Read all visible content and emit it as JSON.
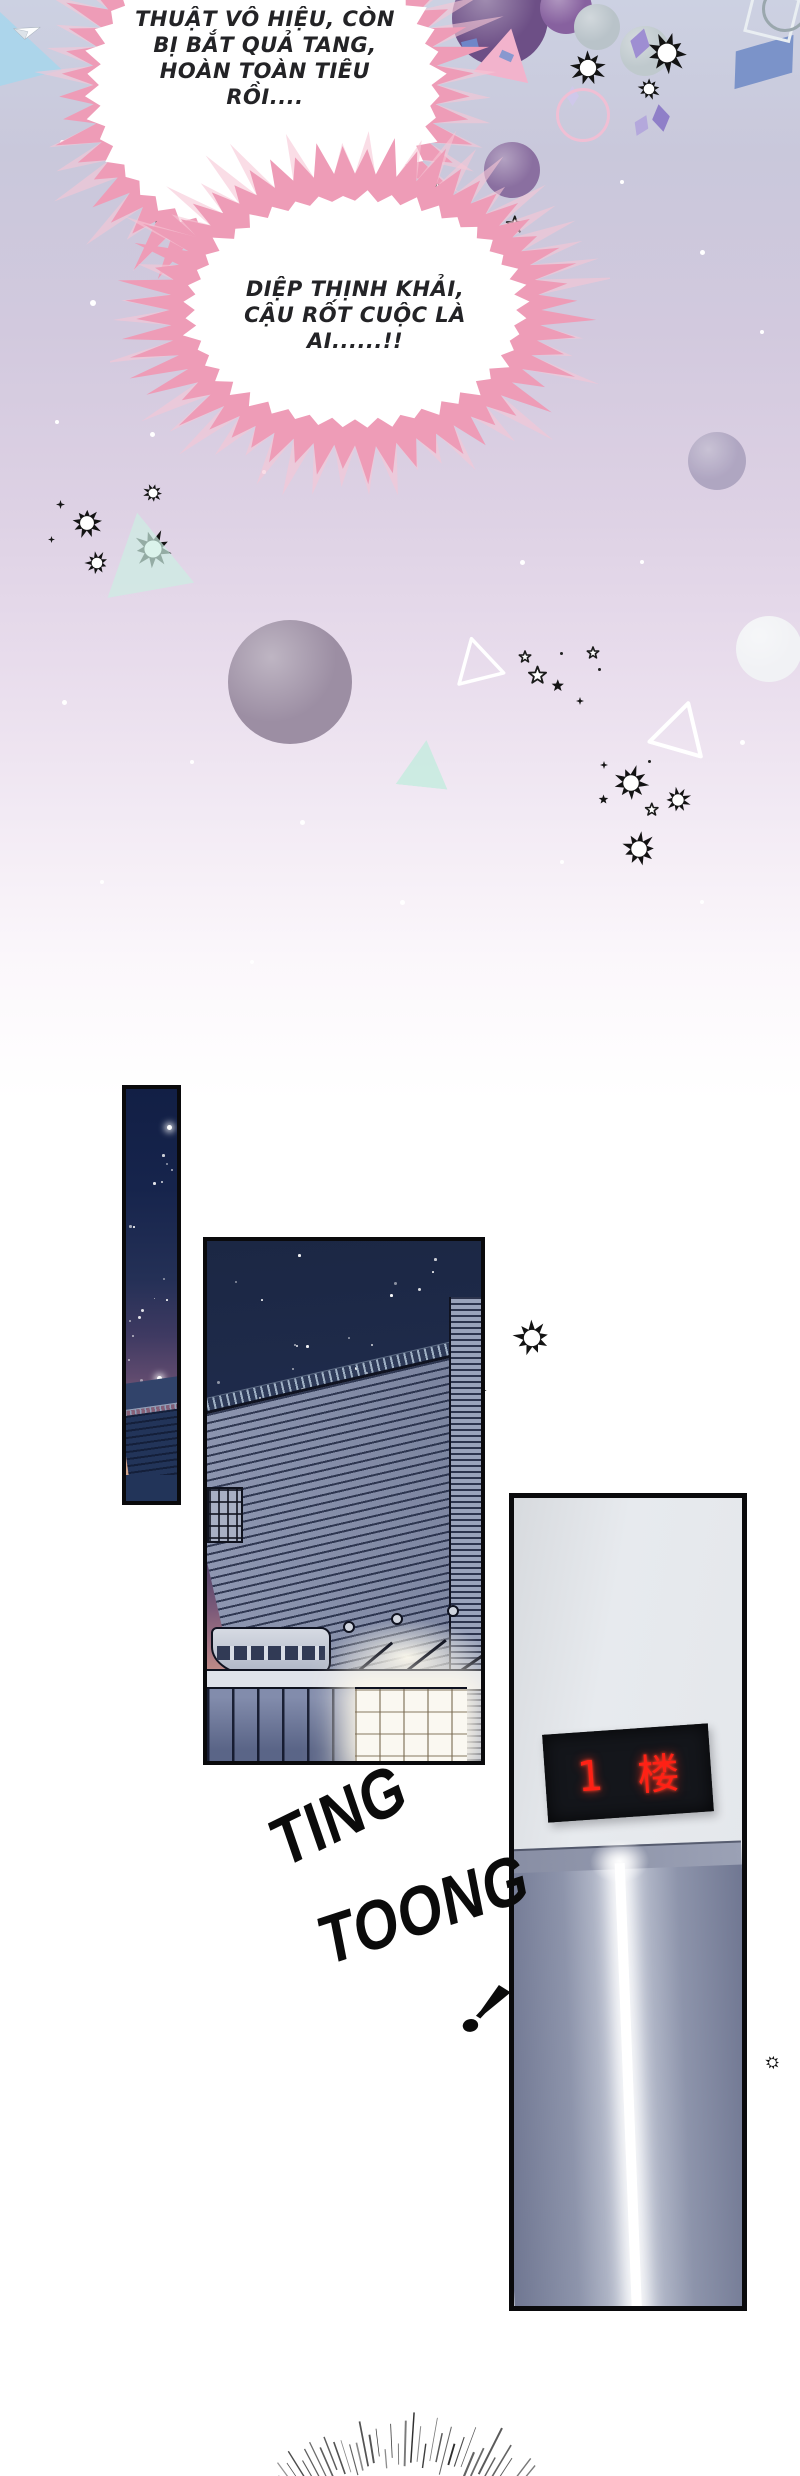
{
  "scene": {
    "type": "comic-webtoon-page",
    "sections": [
      "celebration-burst-speech",
      "night-building-exterior",
      "elevator-arrival"
    ]
  },
  "speech_bubbles": [
    {
      "id": "bubble-1",
      "shape": "spiky-burst",
      "spike_color": "#ee9cb7",
      "lines": [
        "THUẬT VÔ HIỆU, CÒN",
        "BỊ BẮT QUẢ TANG,",
        "HOÀN TOÀN TIÊU",
        "RỒI...."
      ]
    },
    {
      "id": "bubble-2",
      "shape": "spiky-burst",
      "spike_color": "#ee9cb7",
      "lines": [
        "DIỆP THỊNH KHẢI,",
        "CẬU RỐT CUỘC LÀ",
        "AI......!!"
      ]
    }
  ],
  "sfx": {
    "elevator_chime": [
      "TING",
      "TOONG"
    ],
    "exclaim": "!"
  },
  "elevator": {
    "display_floor": "1",
    "display_unit": "楼",
    "display_text_color": "#ff2115",
    "display_bg": "#14161b",
    "wall_color": "#e3e6ea"
  },
  "colors": {
    "background_top": "#ccd1e2",
    "bubble_pink": "#ee9cb7",
    "bubble_pink_light": "#f7c6d6",
    "night_sky": "#1b2744",
    "dusk_peach": "#d3a68e",
    "panel_border": "#0a0a0c"
  },
  "decorations": [
    {
      "t": "wedge",
      "x": 0,
      "y": 12,
      "w": 62,
      "h": 74,
      "c": "#a7d6ec",
      "o": 0.85
    },
    {
      "t": "plane",
      "x": 12,
      "y": 22,
      "s": 26,
      "r": 18
    },
    {
      "t": "ball",
      "x": 452,
      "y": -30,
      "s": 96,
      "c": "#6d4f86"
    },
    {
      "t": "ball",
      "x": 540,
      "y": -18,
      "s": 52,
      "c": "#87619f"
    },
    {
      "t": "ball",
      "x": 574,
      "y": 4,
      "s": 46,
      "c": "#b9c3c9"
    },
    {
      "t": "tri",
      "x": 478,
      "y": 28,
      "s": 56,
      "r": 12,
      "c": "#f2b3cc"
    },
    {
      "t": "rect",
      "x": 462,
      "y": 40,
      "w": 16,
      "h": 10,
      "r": -14,
      "c": "#6f86c8"
    },
    {
      "t": "rect",
      "x": 500,
      "y": 52,
      "w": 13,
      "h": 8,
      "r": 24,
      "c": "#8898cf"
    },
    {
      "t": "ball",
      "x": 620,
      "y": 26,
      "s": 50,
      "c": "#bfc9cd"
    },
    {
      "t": "burst",
      "x": 568,
      "y": 48,
      "s": 40
    },
    {
      "t": "burst",
      "x": 644,
      "y": 30,
      "s": 46
    },
    {
      "t": "burst",
      "x": 636,
      "y": 76,
      "s": 26
    },
    {
      "t": "diamond",
      "x": 630,
      "y": 28,
      "s": 20,
      "r": 15,
      "c": "#9e8ed2"
    },
    {
      "t": "diamond",
      "x": 652,
      "y": 104,
      "s": 18,
      "r": -10,
      "c": "#8f7fc8"
    },
    {
      "t": "diamond",
      "x": 634,
      "y": 114,
      "s": 15,
      "r": 25,
      "c": "#b4a8dc"
    },
    {
      "t": "diamond",
      "x": 566,
      "y": 86,
      "s": 13,
      "r": 0,
      "c": "#cfc8ea"
    },
    {
      "t": "para",
      "x": 734,
      "y": 44,
      "w": 60,
      "h": 36,
      "r": -16,
      "c": "#7b93c9"
    },
    {
      "t": "rect-o",
      "x": 748,
      "y": -8,
      "w": 42,
      "h": 40,
      "r": 14,
      "c": "#e9eef2"
    },
    {
      "t": "ring",
      "x": 762,
      "y": -14,
      "s": 40,
      "c": "#9aa7ad"
    },
    {
      "t": "ball",
      "x": 484,
      "y": 142,
      "s": 56,
      "c": "#8a6fa0"
    },
    {
      "t": "ring",
      "x": 556,
      "y": 88,
      "s": 48,
      "c": "#f0bfd4"
    },
    {
      "t": "star4",
      "x": 406,
      "y": 178,
      "s": 9
    },
    {
      "t": "star",
      "x": 424,
      "y": 176,
      "s": 18
    },
    {
      "t": "star",
      "x": 282,
      "y": 208,
      "s": 13
    },
    {
      "t": "star",
      "x": 360,
      "y": 224,
      "s": 26
    },
    {
      "t": "star",
      "x": 468,
      "y": 206,
      "s": 13
    },
    {
      "t": "star",
      "x": 502,
      "y": 212,
      "s": 17
    },
    {
      "t": "star",
      "x": 150,
      "y": 206,
      "s": 14
    },
    {
      "t": "ball",
      "x": 220,
      "y": 255,
      "s": 30,
      "c": "#f3f5f8"
    },
    {
      "t": "ball",
      "x": 328,
      "y": 254,
      "s": 30,
      "c": "#5d7382"
    },
    {
      "t": "ball",
      "x": 392,
      "y": 262,
      "s": 46,
      "c": "#e9ecef"
    },
    {
      "t": "ball",
      "x": 688,
      "y": 432,
      "s": 58,
      "c": "#a89fbc",
      "o": 0.85
    },
    {
      "t": "plane",
      "x": 165,
      "y": 283,
      "s": 92,
      "r": 10
    },
    {
      "t": "tri",
      "x": 212,
      "y": 354,
      "s": 20,
      "r": -6,
      "c": "#bfe8da",
      "o": 0.8
    },
    {
      "t": "dot",
      "x": 300,
      "y": 222,
      "s": 4,
      "c": "#222"
    },
    {
      "t": "dot",
      "x": 352,
      "y": 228,
      "s": 3,
      "c": "#222"
    },
    {
      "t": "dot",
      "x": 408,
      "y": 244,
      "s": 4,
      "c": "#222"
    },
    {
      "t": "dot",
      "x": 396,
      "y": 256,
      "s": 3,
      "c": "#222"
    },
    {
      "t": "dot",
      "x": 300,
      "y": 242,
      "s": 3,
      "c": "#222"
    },
    {
      "t": "dot",
      "x": 528,
      "y": 270,
      "s": 3,
      "c": "#222"
    },
    {
      "t": "burst",
      "x": 70,
      "y": 506,
      "s": 34
    },
    {
      "t": "burst",
      "x": 142,
      "y": 482,
      "s": 22
    },
    {
      "t": "burst",
      "x": 132,
      "y": 528,
      "s": 42
    },
    {
      "t": "burst",
      "x": 84,
      "y": 550,
      "s": 26
    },
    {
      "t": "star4",
      "x": 56,
      "y": 496,
      "s": 9
    },
    {
      "t": "star4",
      "x": 48,
      "y": 530,
      "s": 7
    },
    {
      "t": "tri",
      "x": 100,
      "y": 512,
      "s": 88,
      "r": -10,
      "c": "#cceee2",
      "o": 0.7
    },
    {
      "t": "ball",
      "x": 228,
      "y": 620,
      "s": 124,
      "c": "#9c8ea3"
    },
    {
      "t": "tri-o",
      "x": 452,
      "y": 636,
      "s": 50,
      "r": -14,
      "c": "#ffffff"
    },
    {
      "t": "star",
      "x": 524,
      "y": 662,
      "s": 18
    },
    {
      "t": "tri",
      "x": 398,
      "y": 740,
      "s": 52,
      "r": 6,
      "c": "#c5ebdf",
      "o": 0.85
    },
    {
      "t": "star",
      "x": 516,
      "y": 648,
      "s": 12
    },
    {
      "t": "star-f",
      "x": 548,
      "y": 676,
      "s": 13
    },
    {
      "t": "star",
      "x": 584,
      "y": 644,
      "s": 12
    },
    {
      "t": "star4",
      "x": 576,
      "y": 692,
      "s": 8
    },
    {
      "t": "dot",
      "x": 560,
      "y": 652,
      "s": 3,
      "c": "#222"
    },
    {
      "t": "dot",
      "x": 598,
      "y": 668,
      "s": 3,
      "c": "#222"
    },
    {
      "t": "ball",
      "x": 736,
      "y": 616,
      "s": 66,
      "c": "#f1f2f5"
    },
    {
      "t": "tri-o",
      "x": 652,
      "y": 700,
      "s": 58,
      "r": 16,
      "c": "#ffffff"
    },
    {
      "t": "burst",
      "x": 612,
      "y": 764,
      "s": 38
    },
    {
      "t": "star",
      "x": 642,
      "y": 800,
      "s": 13
    },
    {
      "t": "burst",
      "x": 664,
      "y": 786,
      "s": 28
    },
    {
      "t": "burst",
      "x": 620,
      "y": 830,
      "s": 38
    },
    {
      "t": "star4",
      "x": 600,
      "y": 756,
      "s": 8
    },
    {
      "t": "star-f",
      "x": 596,
      "y": 792,
      "s": 10
    },
    {
      "t": "dot",
      "x": 648,
      "y": 760,
      "s": 3,
      "c": "#222"
    },
    {
      "t": "dot",
      "x": 60,
      "y": 140,
      "s": 5,
      "c": "#fff"
    },
    {
      "t": "dot",
      "x": 200,
      "y": 170,
      "s": 4,
      "c": "#fff"
    },
    {
      "t": "dot",
      "x": 330,
      "y": 142,
      "s": 5,
      "c": "#fff"
    },
    {
      "t": "dot",
      "x": 90,
      "y": 300,
      "s": 6,
      "c": "#fff"
    },
    {
      "t": "dot",
      "x": 55,
      "y": 420,
      "s": 4,
      "c": "#fff"
    },
    {
      "t": "dot",
      "x": 150,
      "y": 432,
      "s": 5,
      "c": "#fff"
    },
    {
      "t": "dot",
      "x": 262,
      "y": 470,
      "s": 4,
      "c": "#fff"
    },
    {
      "t": "dot",
      "x": 500,
      "y": 380,
      "s": 6,
      "c": "#fff"
    },
    {
      "t": "dot",
      "x": 620,
      "y": 180,
      "s": 4,
      "c": "#fff"
    },
    {
      "t": "dot",
      "x": 700,
      "y": 250,
      "s": 5,
      "c": "#fff"
    },
    {
      "t": "dot",
      "x": 760,
      "y": 330,
      "s": 4,
      "c": "#fff"
    },
    {
      "t": "dot",
      "x": 62,
      "y": 700,
      "s": 5,
      "c": "#fff"
    },
    {
      "t": "dot",
      "x": 190,
      "y": 760,
      "s": 4,
      "c": "#fff"
    },
    {
      "t": "dot",
      "x": 300,
      "y": 820,
      "s": 5,
      "c": "#fff"
    },
    {
      "t": "dot",
      "x": 520,
      "y": 560,
      "s": 5,
      "c": "#fff"
    },
    {
      "t": "dot",
      "x": 640,
      "y": 560,
      "s": 4,
      "c": "#fff"
    },
    {
      "t": "dot",
      "x": 740,
      "y": 740,
      "s": 5,
      "c": "#fff"
    },
    {
      "t": "dot",
      "x": 100,
      "y": 880,
      "s": 4,
      "c": "#fff"
    },
    {
      "t": "dot",
      "x": 400,
      "y": 900,
      "s": 5,
      "c": "#fff"
    },
    {
      "t": "dot",
      "x": 700,
      "y": 900,
      "s": 4,
      "c": "#fff"
    },
    {
      "t": "dot",
      "x": 250,
      "y": 960,
      "s": 4,
      "c": "#fff"
    },
    {
      "t": "dot",
      "x": 560,
      "y": 860,
      "s": 4,
      "c": "#fff"
    },
    {
      "t": "burst",
      "x": 512,
      "y": 1318,
      "s": 40
    },
    {
      "t": "burst",
      "x": 448,
      "y": 1338,
      "s": 26,
      "z": 3
    },
    {
      "t": "burst",
      "x": 452,
      "y": 1372,
      "s": 36,
      "z": 3
    },
    {
      "t": "burst",
      "x": 698,
      "y": 1996,
      "s": 38,
      "z": 3
    },
    {
      "t": "burst",
      "x": 668,
      "y": 2012,
      "s": 22,
      "z": 3
    },
    {
      "t": "burst",
      "x": 688,
      "y": 2062,
      "s": 36,
      "z": 3
    },
    {
      "t": "burst",
      "x": 764,
      "y": 2054,
      "s": 17
    }
  ]
}
